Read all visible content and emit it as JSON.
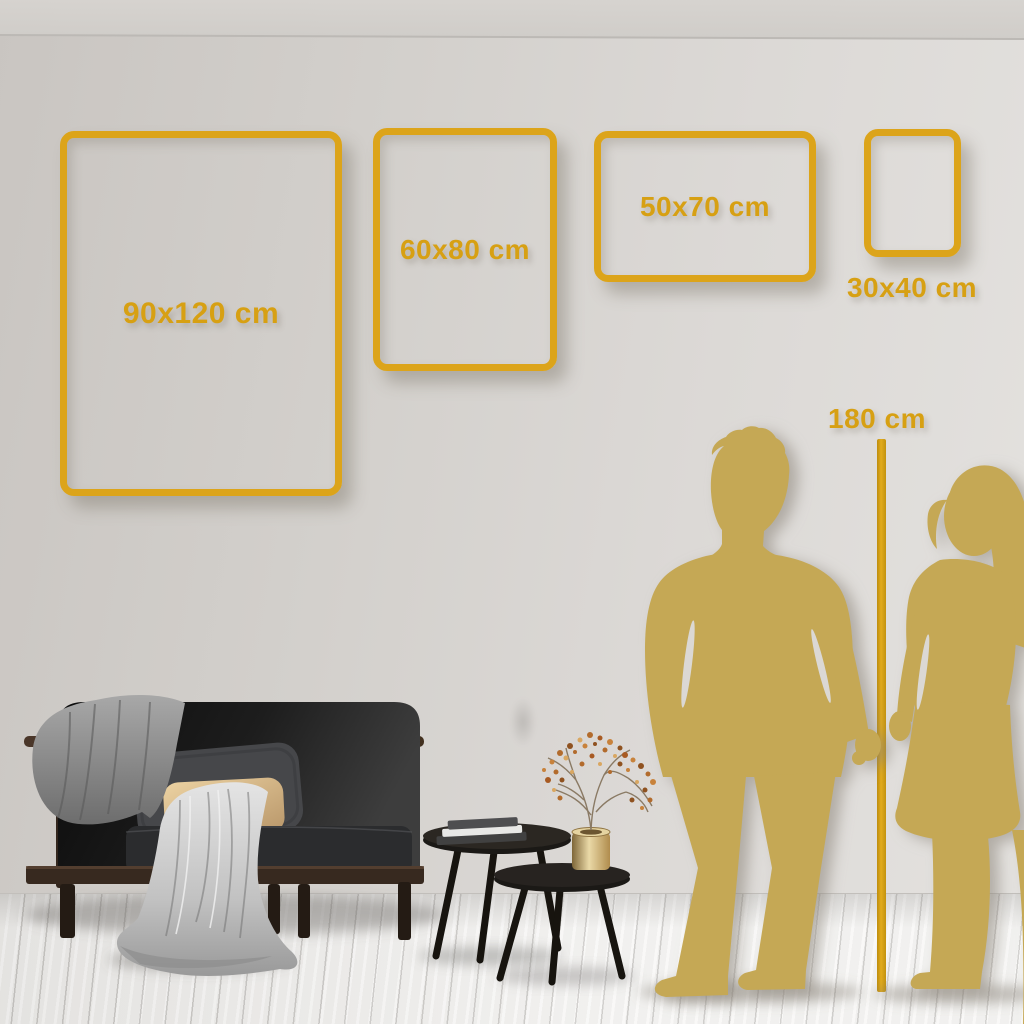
{
  "size_guide": {
    "frames": [
      {
        "label": "90x120 cm"
      },
      {
        "label": "60x80 cm"
      },
      {
        "label": "50x70 cm"
      },
      {
        "label": "30x40 cm"
      }
    ],
    "height_reference_label": "180 cm"
  },
  "colors": {
    "accent_gold": "#D7A013",
    "frame_gold": "#DCA41A",
    "silhouette_gold": "#C5A855",
    "wall_gray": "#D3D0CC",
    "floor_white": "#EFEEEC"
  }
}
